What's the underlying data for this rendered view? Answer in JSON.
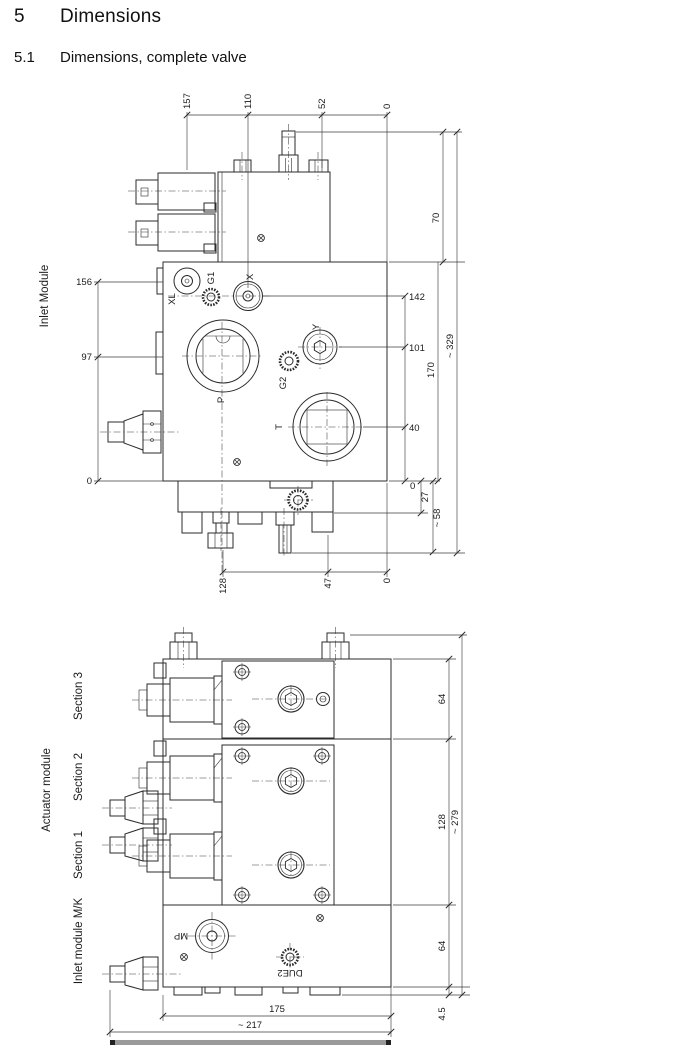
{
  "heading": {
    "number": "5",
    "title": "Dimensions"
  },
  "subheading": {
    "number": "5.1",
    "title": "Dimensions, complete valve"
  },
  "top_drawing": {
    "side_label": "Inlet Module",
    "ports": {
      "xl": "XL",
      "g1": "G1",
      "x": "X",
      "p": "P",
      "g2": "G2",
      "y": "Y",
      "t": "T"
    },
    "dims": {
      "top": [
        "157",
        "110",
        "52",
        "0"
      ],
      "left": [
        "156",
        "97",
        "0"
      ],
      "height_marks": [
        "142",
        "101",
        "40"
      ],
      "stack_70": "70",
      "stack_170": "170",
      "overall_height": "~ 329",
      "below_body": [
        "0",
        "27",
        "~ 58"
      ],
      "bottom": [
        "128",
        "47",
        "0"
      ]
    }
  },
  "bottom_drawing": {
    "module_label": "Actuator module",
    "section_labels": [
      "Section 3",
      "Section 2",
      "Section 1"
    ],
    "inlet_label": "Inlet module M/K",
    "ports": {
      "mp": "MP",
      "due2": "DUE2"
    },
    "dims": {
      "right": [
        "64",
        "128",
        "64",
        "4.5"
      ],
      "overall_height": "~ 279",
      "body_width": "175",
      "overall_width": "~ 217"
    }
  }
}
